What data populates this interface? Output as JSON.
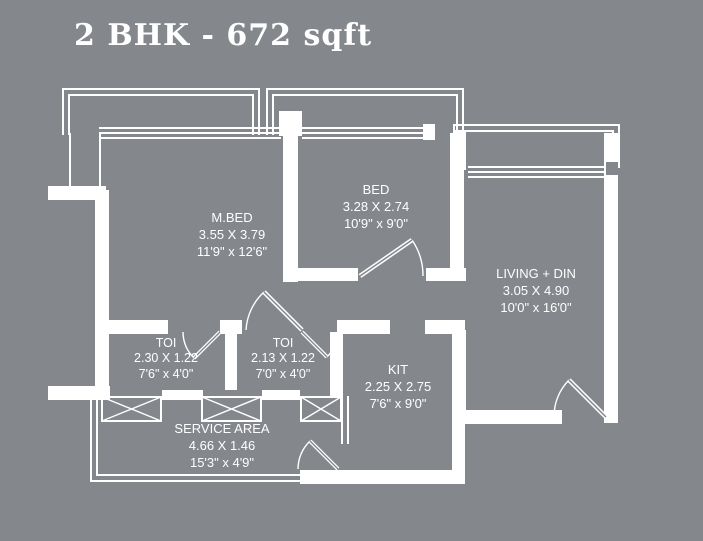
{
  "title": "2 BHK - 672 sqft",
  "colors": {
    "background": "#84878c",
    "line": "#ffffff",
    "text": "#ffffff"
  },
  "rooms": [
    {
      "id": "mbed",
      "name": "M.BED",
      "dims_m": "3.55 X 3.79",
      "dims_ft": "11'9\" x 12'6\""
    },
    {
      "id": "bed",
      "name": "BED",
      "dims_m": "3.28 X 2.74",
      "dims_ft": "10'9\" x 9'0\""
    },
    {
      "id": "living",
      "name": "LIVING + DIN",
      "dims_m": "3.05 X 4.90",
      "dims_ft": "10'0\" x 16'0\""
    },
    {
      "id": "toi1",
      "name": "TOI",
      "dims_m": "2.30 X 1.22",
      "dims_ft": "7'6\" x 4'0\""
    },
    {
      "id": "toi2",
      "name": "TOI",
      "dims_m": "2.13 X 1.22",
      "dims_ft": "7'0\" x 4'0\""
    },
    {
      "id": "kit",
      "name": "KIT",
      "dims_m": "2.25 X 2.75",
      "dims_ft": "7'6\" x 9'0\""
    },
    {
      "id": "service",
      "name": "SERVICE  AREA",
      "dims_m": "4.66 X 1.46",
      "dims_ft": "15'3\" x 4'9\""
    }
  ]
}
